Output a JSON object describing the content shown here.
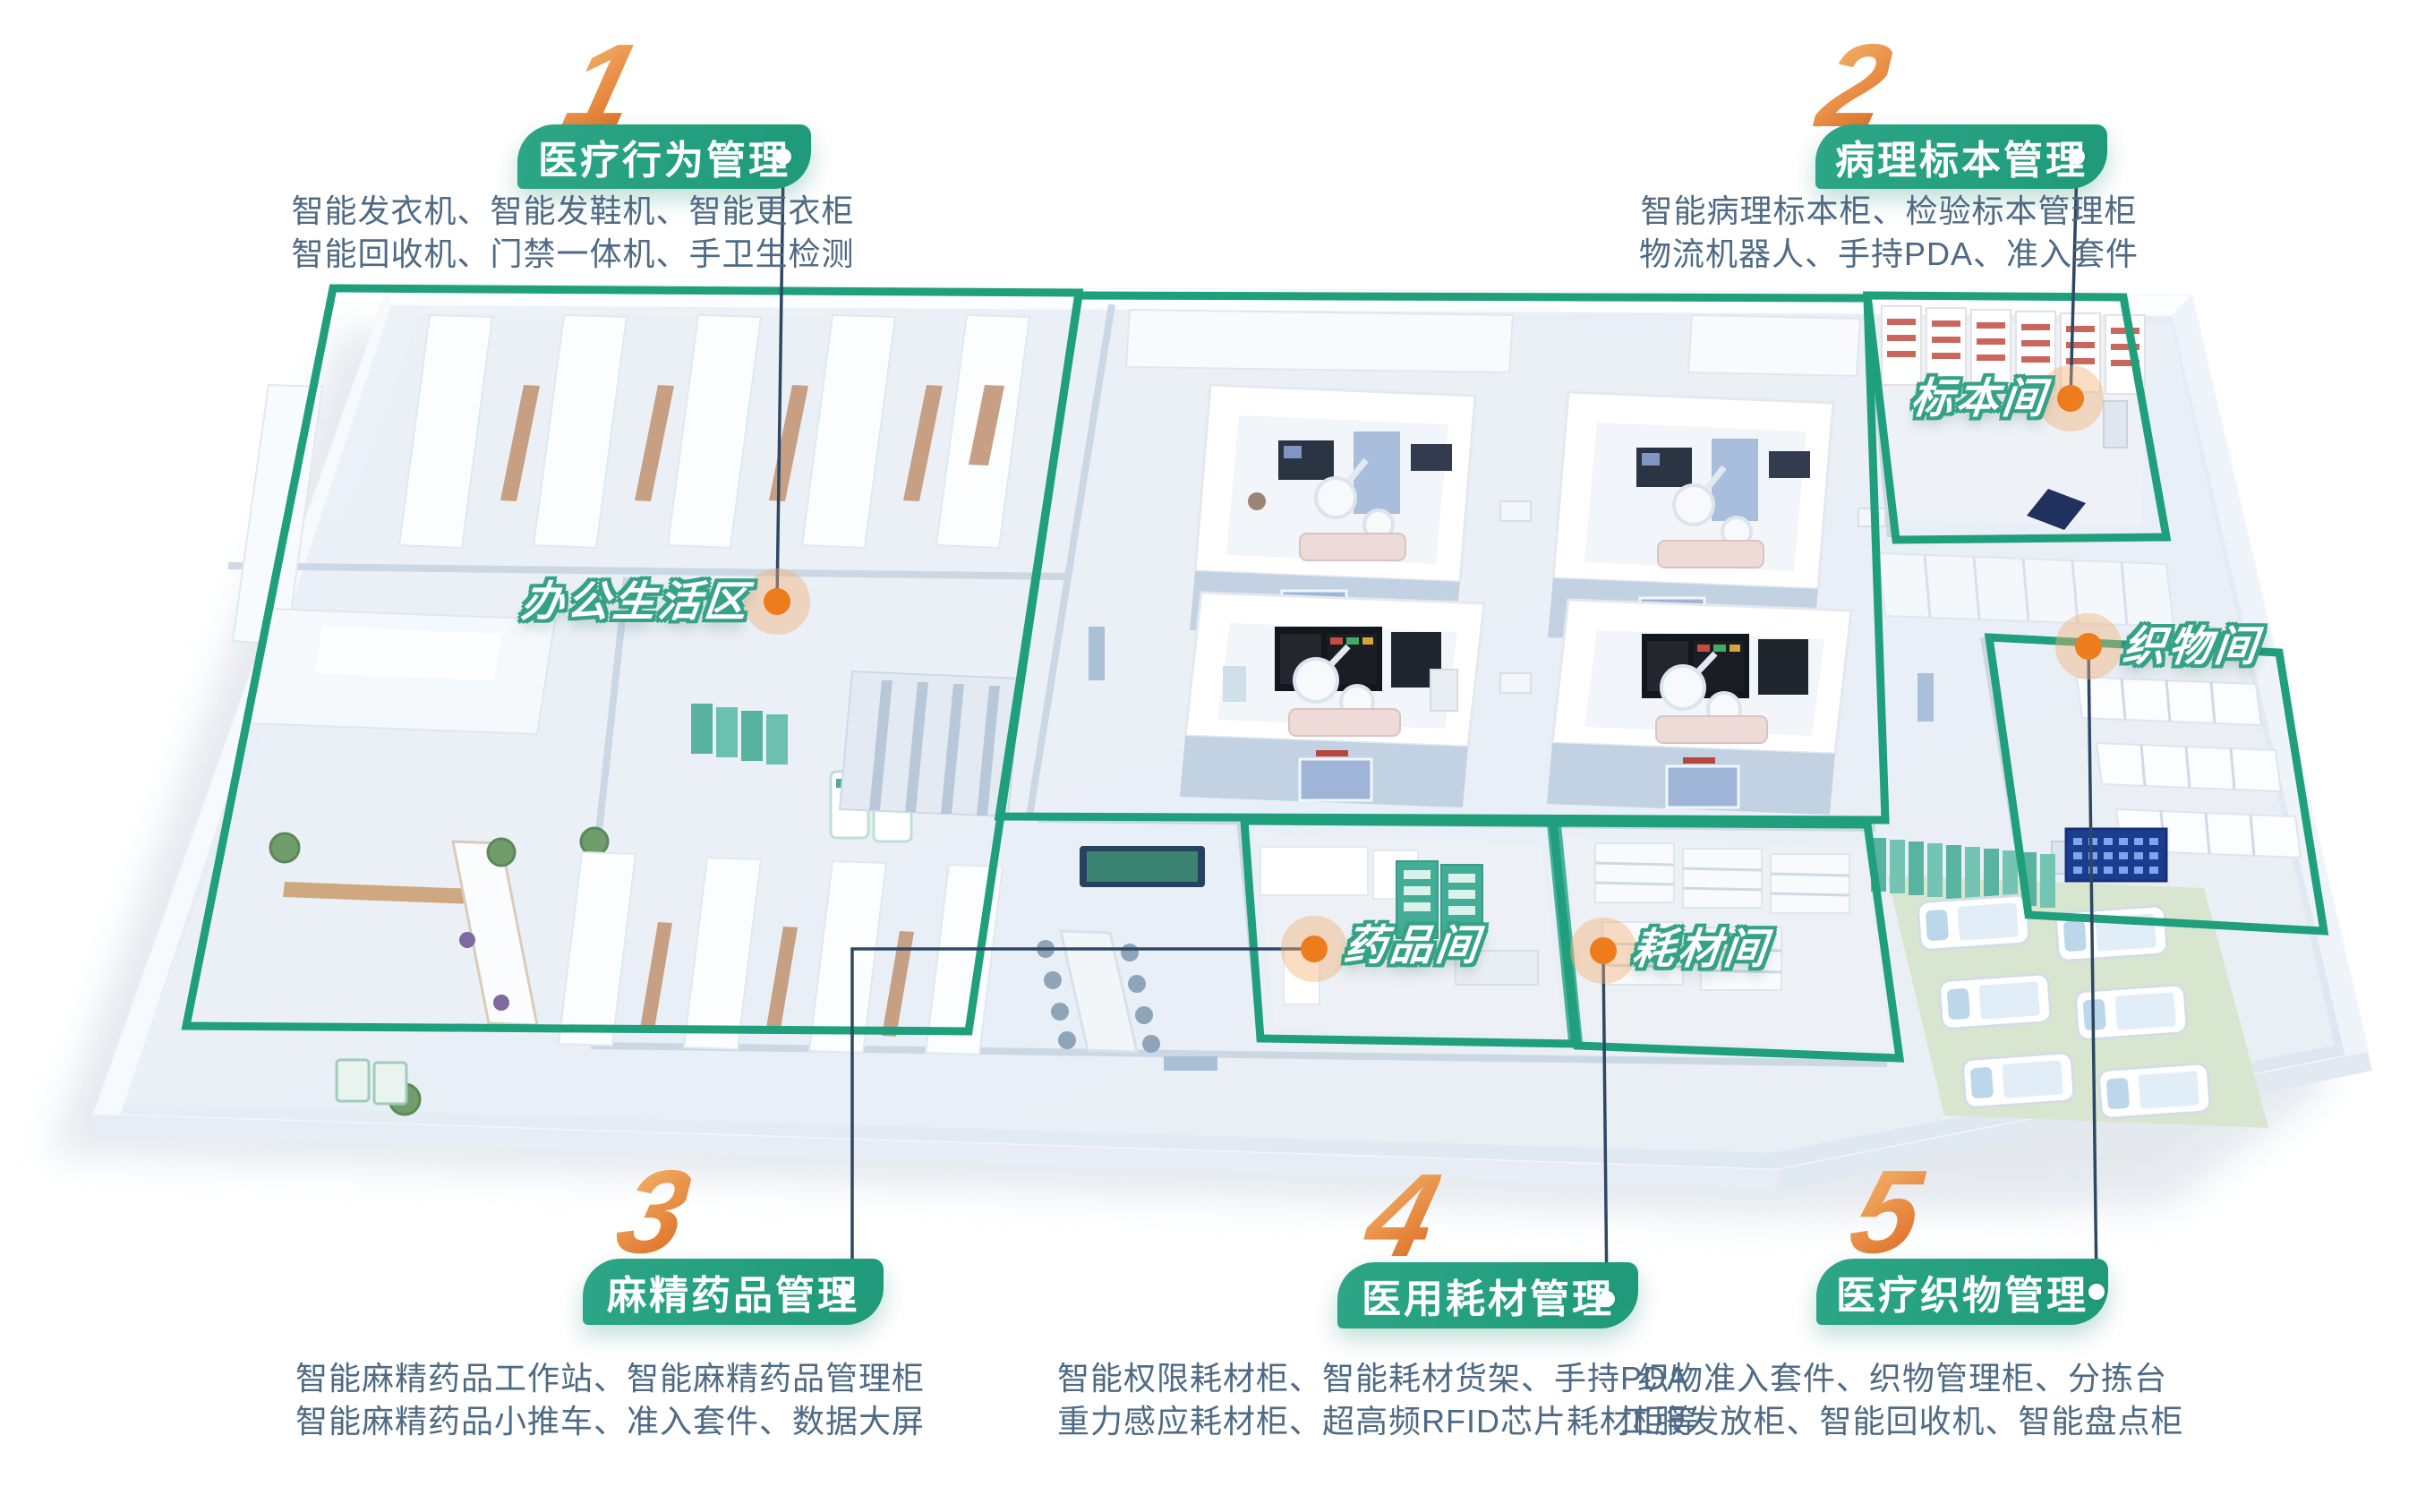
{
  "colors": {
    "accent_green": "#21a07e",
    "accent_orange": "#ed7d1c",
    "number_gradient_start": "#f4b269",
    "number_gradient_end": "#df7129",
    "description_text": "#4e6a84",
    "connector_line": "#2e4763",
    "room_label_outline": "#35a287"
  },
  "sections": [
    {
      "number": "1",
      "title": "医疗行为管理",
      "line1": "智能发衣机、智能发鞋机、智能更衣柜",
      "line2": "智能回收机、门禁一体机、手卫生检测"
    },
    {
      "number": "2",
      "title": "病理标本管理",
      "line1": "智能病理标本柜、检验标本管理柜",
      "line2": "物流机器人、手持PDA、准入套件"
    },
    {
      "number": "3",
      "title": "麻精药品管理",
      "line1": "智能麻精药品工作站、智能麻精药品管理柜",
      "line2": "智能麻精药品小推车、准入套件、数据大屏"
    },
    {
      "number": "4",
      "title": "医用耗材管理",
      "line1": "智能权限耗材柜、智能耗材货架、手持PDA",
      "line2": "重力感应耗材柜、超高频RFID芯片耗材柜等"
    },
    {
      "number": "5",
      "title": "医疗织物管理",
      "line1": "织物准入套件、织物管理柜、分拣台",
      "line2": "工服发放柜、智能回收机、智能盘点柜"
    }
  ],
  "rooms": [
    {
      "label": "办公生活区"
    },
    {
      "label": "标本间"
    },
    {
      "label": "织物间"
    },
    {
      "label": "药品间"
    },
    {
      "label": "耗材间"
    }
  ]
}
